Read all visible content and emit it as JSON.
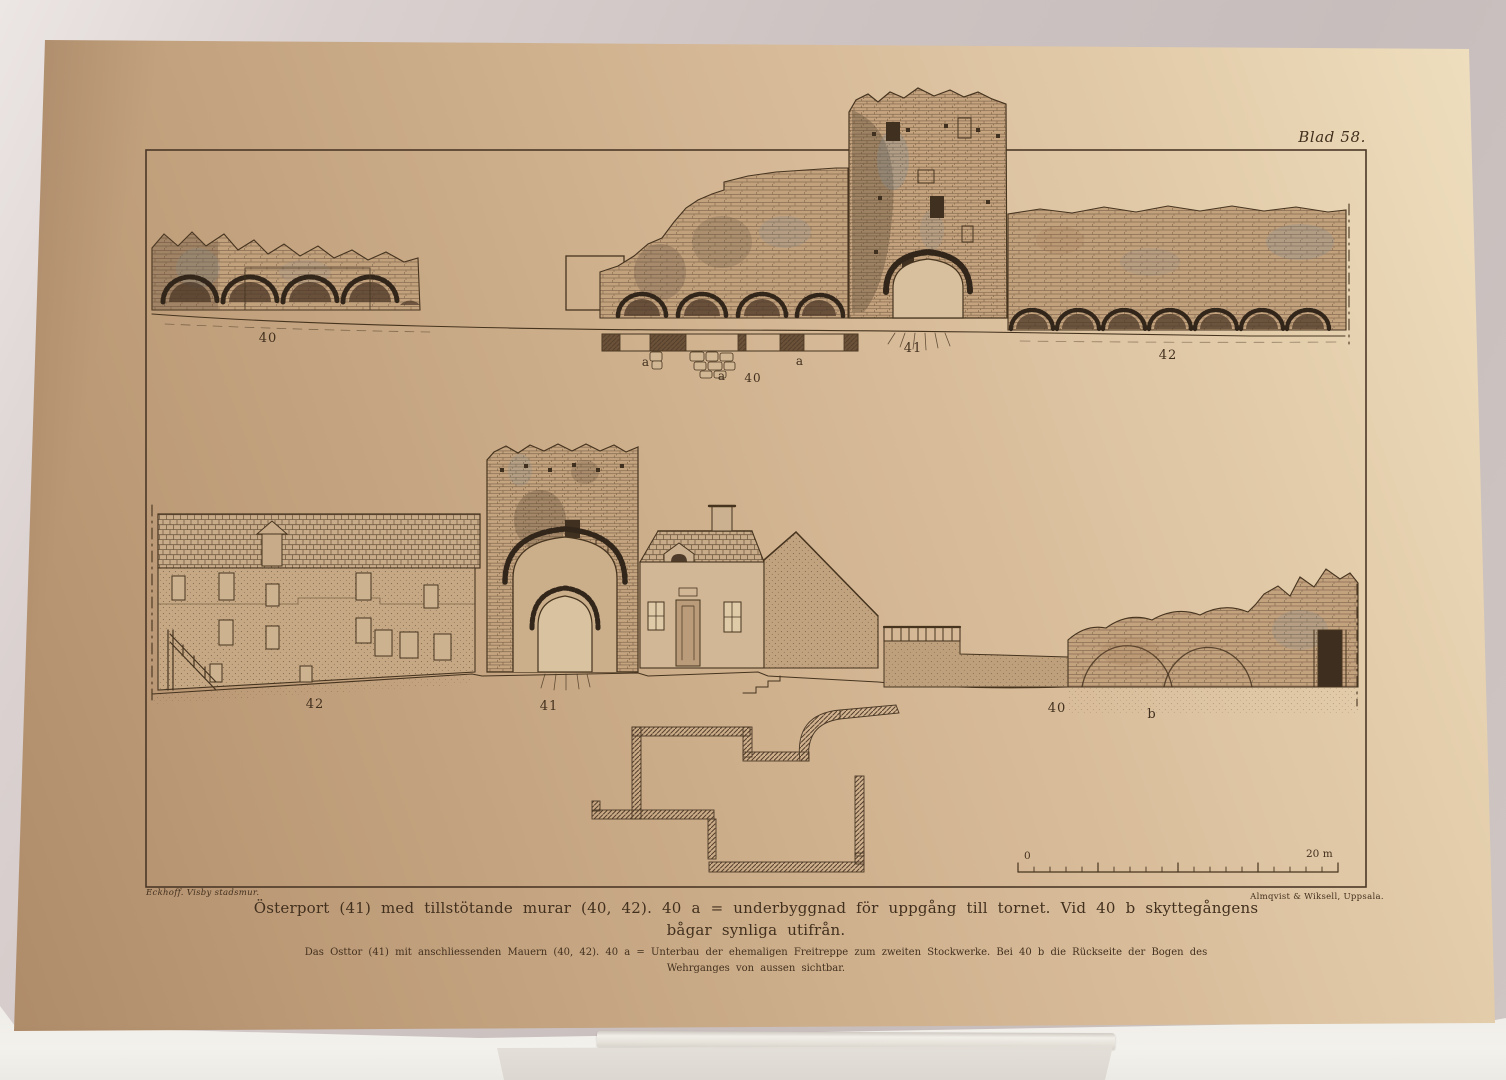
{
  "photo": {
    "subject": "Antique printed plate of Visby town wall elevations standing on a small display stand"
  },
  "plate": {
    "sheet_label": "Blad 58.",
    "credit_left": "Eckhoff.  Visby stadsmur.",
    "credit_right": "Almqvist & Wiksell, Uppsala.",
    "caption_swedish_line1": "Österport (41) med tillstötande murar (40, 42).  40 a = underbyggnad för uppgång till tornet.  Vid 40 b skyttegångens",
    "caption_swedish_line2": "bågar synliga utifrån.",
    "caption_german_line1": "Das Osttor (41) mit anschliessenden Mauern (40, 42).  40 a = Unterbau der ehemaligen Freitreppe zum zweiten Stockwerke.  Bei 40 b die Rückseite der Bogen des",
    "caption_german_line2": "Wehrganges von aussen sichtbar.",
    "scale_bar": {
      "zero_label": "0",
      "end_label": "20 m"
    },
    "labels": {
      "top_wall_left": "40",
      "top_gate_tower": "41",
      "top_wall_right": "42",
      "detail_a_left": "a",
      "detail_a_mid": "a",
      "detail_number": "40",
      "detail_a_right": "a",
      "bottom_wall_left": "42",
      "bottom_gate_tower": "41",
      "bottom_wall_right": "40",
      "bottom_b": "b"
    },
    "ink_color": "#46341f",
    "paper_color": "#cfae8c"
  }
}
